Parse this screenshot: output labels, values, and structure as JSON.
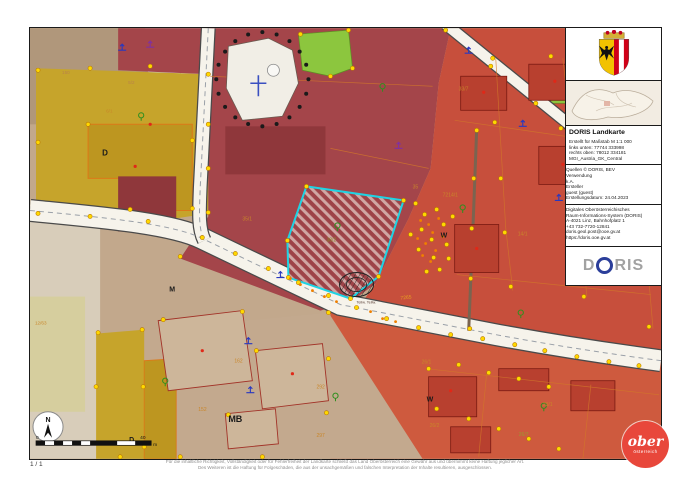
{
  "panel": {
    "title": "DORIS Landkarte",
    "meta_lines": [
      "Erstellt für Maßstab M 1:1 000",
      "links unten: 77744 333998",
      "rechts oben: 78012 334181",
      "MGI_Austria_GK_Central"
    ],
    "source_lines": [
      "Quellen © DORIS, BEV",
      "Verwendung",
      "k.A.",
      "Ersteller",
      "guest (guest)",
      "Erstellungsdatum: 24.04.2023"
    ],
    "contact_lines": [
      "Digitales Oberösterreichisches",
      "Raum-Informations-System (DORIS)",
      "A-4021 Linz, Bahnhofplatz 1",
      "+43 732-7720-12841",
      "doris.geol.post@ooe.gv.at",
      "https://doris.ooe.gv.at"
    ],
    "logo": {
      "d": "D",
      "ris": "RIS"
    }
  },
  "footer": {
    "page_indicator": "1 / 1",
    "disclaimer_line1": "Für die inhaltliche Richtigkeit, Vollständigkeit oder für Fehlerfreiheit der Landkarte schließt das Land Oberösterreich eine Gewähr aus und übernimmt keine Haftung jeglicher Art.",
    "disclaimer_line2": "Des Weiteren ist die Haftung für Folgeschäden, die aus der unsachgemäßen und falschen Interpretation der Inhalte resultieren, ausgeschlossen."
  },
  "scalebar": {
    "start": "0",
    "end": "40",
    "unit": "m"
  },
  "north_label": "N",
  "brand_logo": {
    "line1": "ober",
    "line2": "österreich"
  },
  "colors": {
    "highlight_cyan": "#1fd3e3",
    "doris_blue": "#2b3e9a",
    "land_red": "#e8473b",
    "parcel_dot_yellow": "#ffd800",
    "dark_red_zone": "#a4454a",
    "bright_red_zone": "#c74f3c",
    "yellow_zone": "#c6a42b",
    "tan_zone": "#c3a98e"
  },
  "map": {
    "labels": [
      {
        "t": "150",
        "x": 32,
        "y": 46,
        "c": "#b9824a",
        "s": 4.6
      },
      {
        "t": "5/2",
        "x": 98,
        "y": 56,
        "c": "#b9824a",
        "s": 4.6
      },
      {
        "t": "6/1",
        "x": 76,
        "y": 84,
        "c": "#c9862a",
        "s": 4.6
      },
      {
        "t": "35/1",
        "x": 212,
        "y": 192,
        "c": "#c9862a",
        "s": 5
      },
      {
        "t": "35",
        "x": 382,
        "y": 160,
        "c": "#c9862a",
        "s": 5
      },
      {
        "t": "33/7",
        "x": 428,
        "y": 62,
        "c": "#c9862a",
        "s": 5
      },
      {
        "t": "7214/1",
        "x": 412,
        "y": 168,
        "c": "#c9862a",
        "s": 5
      },
      {
        "t": "14/1",
        "x": 487,
        "y": 207,
        "c": "#c9862a",
        "s": 5
      },
      {
        "t": "7265",
        "x": 370,
        "y": 271,
        "c": "#e8a020",
        "s": 5,
        "r": -6
      },
      {
        "t": "26/1",
        "x": 391,
        "y": 335,
        "c": "#c9862a",
        "s": 5
      },
      {
        "t": "26/2",
        "x": 399,
        "y": 398,
        "c": "#c9862a",
        "s": 5
      },
      {
        "t": "26/7",
        "x": 488,
        "y": 407,
        "c": "#9a9a30",
        "s": 5
      },
      {
        "t": "23/1",
        "x": 512,
        "y": 377,
        "c": "#c9862a",
        "s": 5
      },
      {
        "t": "162",
        "x": 204,
        "y": 334,
        "c": "#c9862a",
        "s": 5
      },
      {
        "t": "152",
        "x": 168,
        "y": 382,
        "c": "#c9862a",
        "s": 5
      },
      {
        "t": "292",
        "x": 286,
        "y": 360,
        "c": "#c9862a",
        "s": 5
      },
      {
        "t": "297",
        "x": 286,
        "y": 408,
        "c": "#c9862a",
        "s": 5
      },
      {
        "t": "12/63",
        "x": 5,
        "y": 296,
        "c": "#c9862a",
        "s": 4.6
      },
      {
        "t": "38/2",
        "x": 296,
        "y": 213,
        "c": "#8b8b2a",
        "s": 5
      },
      {
        "t": "D",
        "x": 72,
        "y": 127,
        "c": "#1a1a1a",
        "s": 8,
        "b": 1
      },
      {
        "t": "M",
        "x": 139,
        "y": 263,
        "c": "#1a1a1a",
        "s": 7,
        "b": 1
      },
      {
        "t": "MB",
        "x": 198,
        "y": 393,
        "c": "#1a1a1a",
        "s": 9,
        "b": 1
      },
      {
        "t": "W",
        "x": 410,
        "y": 209,
        "c": "#1a1a1a",
        "s": 7,
        "b": 1
      },
      {
        "t": "W",
        "x": 396,
        "y": 373,
        "c": "#1a1a1a",
        "s": 7,
        "b": 1
      },
      {
        "t": "D",
        "x": 99,
        "y": 413,
        "c": "#1a1a1a",
        "s": 7,
        "b": 1
      },
      {
        "t": "Teilw. Teilw.",
        "x": 326,
        "y": 275,
        "c": "#5a4038",
        "s": 3.8
      }
    ]
  }
}
